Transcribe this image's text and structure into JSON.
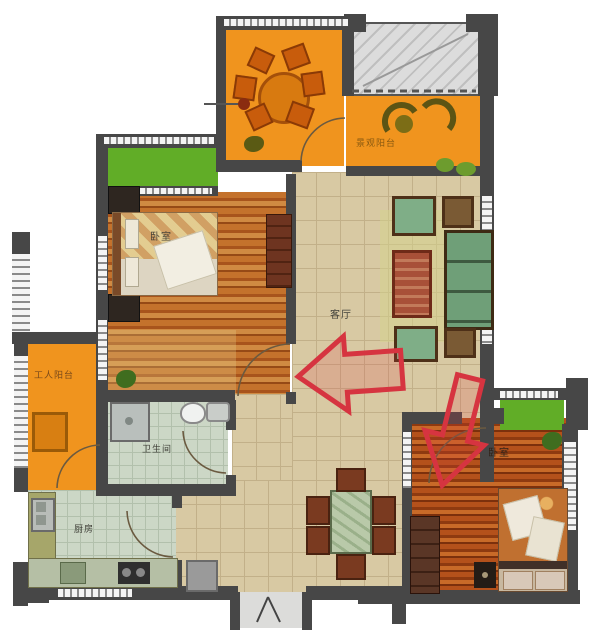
{
  "rooms": {
    "master_bedroom": {
      "label": "卧室"
    },
    "living_room": {
      "label": "客厅"
    },
    "bathroom": {
      "label": "卫生间"
    },
    "kitchen": {
      "label": "厨房"
    },
    "second_bedroom": {
      "label": "卧室"
    },
    "service_balcony": {
      "label": "工人阳台"
    },
    "landscape_balcony": {
      "label": "景观阳台"
    }
  },
  "colors": {
    "balcony_orange": "#f0941e",
    "lawn_green": "#61ad27",
    "wall_gray": "#474747",
    "tile_beige": "#d8c9a3",
    "tile_green": "#ccd7c6",
    "wood_warm": "#b4641f",
    "wood_dark": "#a04818",
    "annotation_red": "#d63440",
    "platform_gray": "#dcdcdc"
  }
}
